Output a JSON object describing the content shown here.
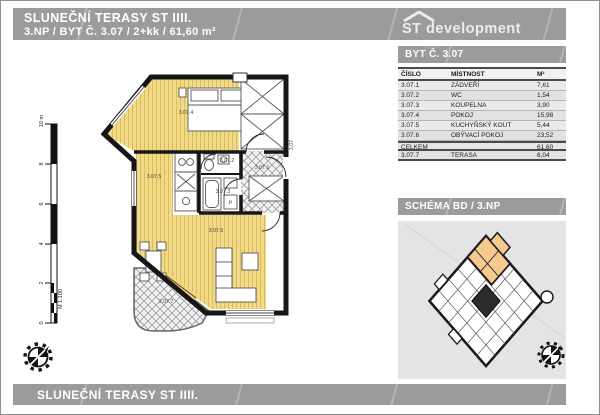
{
  "header": {
    "title_line1": "SLUNEČNÍ TERASY ST IIII.",
    "title_line2": "3.NP / BYT Č. 3.07 / 2+kk / 61,60 m²",
    "logo_text": "ST development"
  },
  "sidebar": {
    "apartment_header": "BYT Č. 3.07",
    "schema_header": "SCHÉMA BD / 3.NP",
    "table": {
      "columns": [
        "ČÍSLO",
        "MÍSTNOST",
        "M²"
      ],
      "rows": [
        {
          "cislo": "3.07.1",
          "mistnost": "ZÁDVEŘÍ",
          "m2": "7,61"
        },
        {
          "cislo": "3.07.2",
          "mistnost": "WC",
          "m2": "1,54"
        },
        {
          "cislo": "3.07.3",
          "mistnost": "KOUPELNA",
          "m2": "3,90"
        },
        {
          "cislo": "3.07.4",
          "mistnost": "POKOJ",
          "m2": "15,98"
        },
        {
          "cislo": "3.07.5",
          "mistnost": "KUCHYŇSKÝ KOUT",
          "m2": "5,44"
        },
        {
          "cislo": "3.07.6",
          "mistnost": "OBÝVACÍ POKOJ",
          "m2": "23,52"
        }
      ],
      "total": {
        "label": "CELKEM",
        "m2": "61,60"
      },
      "extra": {
        "cislo": "3.07.7",
        "mistnost": "TERASA",
        "m2": "6,04"
      }
    }
  },
  "floorplan": {
    "unit_label": "3.07",
    "room_labels": [
      "3.07.1",
      "3.07.2",
      "3.07.3",
      "3.07.4",
      "3.07.5",
      "3.07.6",
      "3.07.7"
    ],
    "washer_label": "P",
    "scale": {
      "label": "M 1:100",
      "ticks": [
        "0",
        "2",
        "4",
        "6",
        "8",
        "10 m"
      ]
    }
  },
  "footer": {
    "title": "SLUNEČNÍ TERASY ST IIII."
  },
  "colors": {
    "bar_gray": "#9b9b9b",
    "floor_yellow": "#f2da86",
    "floor_stripe": "#d9bc60",
    "highlight_orange": "#f6c98e",
    "schema_bg": "#e4e4e4",
    "wall_black": "#161616"
  }
}
